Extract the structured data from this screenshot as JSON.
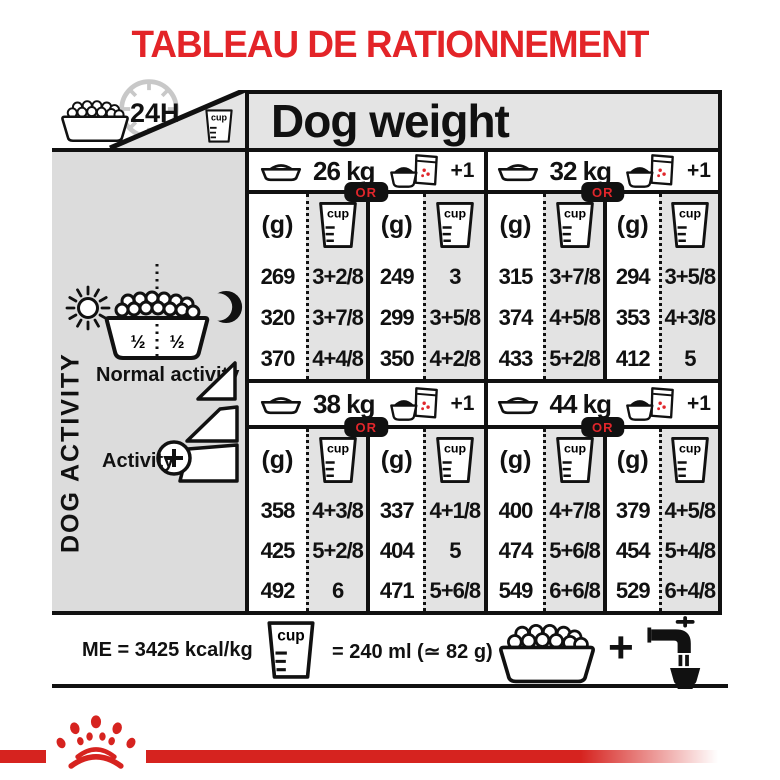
{
  "title": "TABLEAU DE RATIONNEMENT",
  "header": {
    "duration_label": "24H",
    "dog_weight_label": "Dog weight"
  },
  "labels": {
    "cup": "cup"
  },
  "sidebar": {
    "dog_activity_label": "DOG ACTIVITY",
    "half_left": "½",
    "half_right": "½",
    "normal_activity_label": "Normal activity",
    "activity_label": "Activity"
  },
  "table": {
    "unit_g": "(g)",
    "or_label": "OR",
    "plus_one": "+1",
    "blocks": [
      {
        "weight": "26 kg",
        "kibble_only": {
          "g": [
            "269",
            "320",
            "370"
          ],
          "cups": [
            "3+2/8",
            "3+7/8",
            "4+4/8"
          ]
        },
        "kibble_plus_pouch": {
          "g": [
            "249",
            "299",
            "350"
          ],
          "cups": [
            "3",
            "3+5/8",
            "4+2/8"
          ]
        }
      },
      {
        "weight": "32 kg",
        "kibble_only": {
          "g": [
            "315",
            "374",
            "433"
          ],
          "cups": [
            "3+7/8",
            "4+5/8",
            "5+2/8"
          ]
        },
        "kibble_plus_pouch": {
          "g": [
            "294",
            "353",
            "412"
          ],
          "cups": [
            "3+5/8",
            "4+3/8",
            "5"
          ]
        }
      },
      {
        "weight": "38 kg",
        "kibble_only": {
          "g": [
            "358",
            "425",
            "492"
          ],
          "cups": [
            "4+3/8",
            "5+2/8",
            "6"
          ]
        },
        "kibble_plus_pouch": {
          "g": [
            "337",
            "404",
            "471"
          ],
          "cups": [
            "4+1/8",
            "5",
            "5+6/8"
          ]
        }
      },
      {
        "weight": "44 kg",
        "kibble_only": {
          "g": [
            "400",
            "474",
            "549"
          ],
          "cups": [
            "4+7/8",
            "5+6/8",
            "6+6/8"
          ]
        },
        "kibble_plus_pouch": {
          "g": [
            "379",
            "454",
            "529"
          ],
          "cups": [
            "4+5/8",
            "5+4/8",
            "6+4/8"
          ]
        }
      }
    ]
  },
  "footer": {
    "me_label": "ME = 3425 kcal/kg",
    "cup_equation": "= 240 ml (≃ 82 g)",
    "plus_sign": "+"
  },
  "colors": {
    "accent_red": "#e32428",
    "brand_bar_red": "#d6231f",
    "table_gray": "#e3e3e3",
    "sidebar_gray": "#dcdcdc",
    "ink_black": "#111111"
  }
}
